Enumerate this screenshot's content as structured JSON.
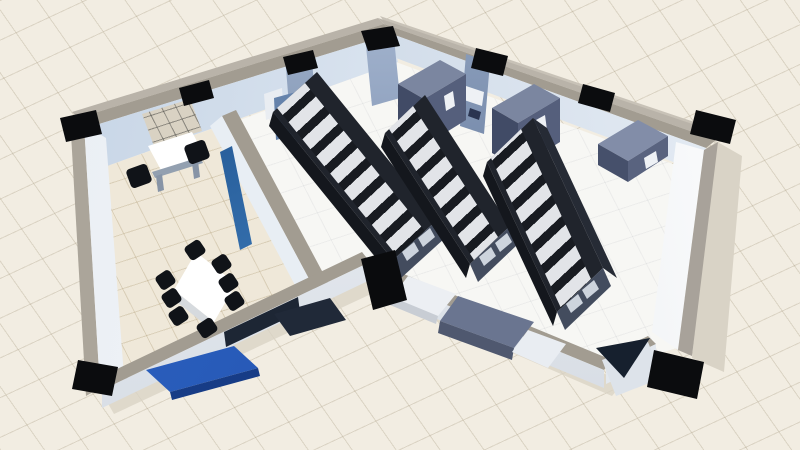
{
  "scene": {
    "type": "isometric-3d-floorplan",
    "subject": "Data center digital-twin view: V-shaped building with a server hall (three enclosed rack rows with containment roofs, three CRAC cooling units, wall cabinets) and an adjoining meeting room (conference table with eight chairs, desk with two chairs, wall board, wall-mounted display)",
    "rooms": [
      {
        "name": "server-hall",
        "floor_style": "white raised-floor tile",
        "contents": [
          "rack-row-1",
          "rack-row-2",
          "rack-row-3",
          "crac-unit-1",
          "crac-unit-2",
          "crac-unit-3",
          "blue-wall-cabinet",
          "wall-panel",
          "floor-mat"
        ]
      },
      {
        "name": "meeting-room",
        "floor_style": "beige tile",
        "contents": [
          "conference-table",
          "conference-chairs x8",
          "desk",
          "desk-chairs x2",
          "wall-grid-board",
          "wall-display"
        ]
      },
      {
        "name": "exterior",
        "contents": [
          "entrance-ramp",
          "door-panel",
          "console-desk",
          "glass-panel"
        ]
      }
    ],
    "counts": {
      "rack_rows": 3,
      "roof_panels_per_row": 8,
      "door_windows_per_row": 2,
      "crac_units": 3,
      "structural_pillars": 10,
      "conference_chairs": 8,
      "desk_chairs": 2
    },
    "colors": {
      "bg": "#f2ede2",
      "wall-cap": "#a29c91",
      "wall-outer-band": "#b9b3a9",
      "wall-face-blue": "#c3d2e4",
      "pillar": "#0b0c0e",
      "floor-hall": "#f7f7f4",
      "floor-meeting": "#efe8d9",
      "rack-body": "#20242c",
      "rack-face": "#14171d",
      "rack-side": "#262b35",
      "rack-door": "#434c5e",
      "rack-window": "#cdd4dd",
      "roof-panel": "#e2e4e8",
      "roof-bar": "#181b21",
      "crac-top": "#7b86a0",
      "crac-front": "#414b66",
      "crac-side": "#555f7c",
      "crac-label": "#eef1f5",
      "pier": "#5c7094",
      "pier-light": "#a5b6d0",
      "tv-blue-dark": "#16457f",
      "tv-blue": "#549bdd",
      "ramp-blue": "#2f66c6",
      "ramp-edge": "#173c86",
      "mat": "#202938",
      "glass": "#16202e",
      "slab-top": "#6a7590",
      "slab-front": "#4f586f",
      "shadow": "#d9d3c6",
      "table": "#ffffff",
      "chair": "#101318",
      "board": "#d9d2c3"
    }
  }
}
